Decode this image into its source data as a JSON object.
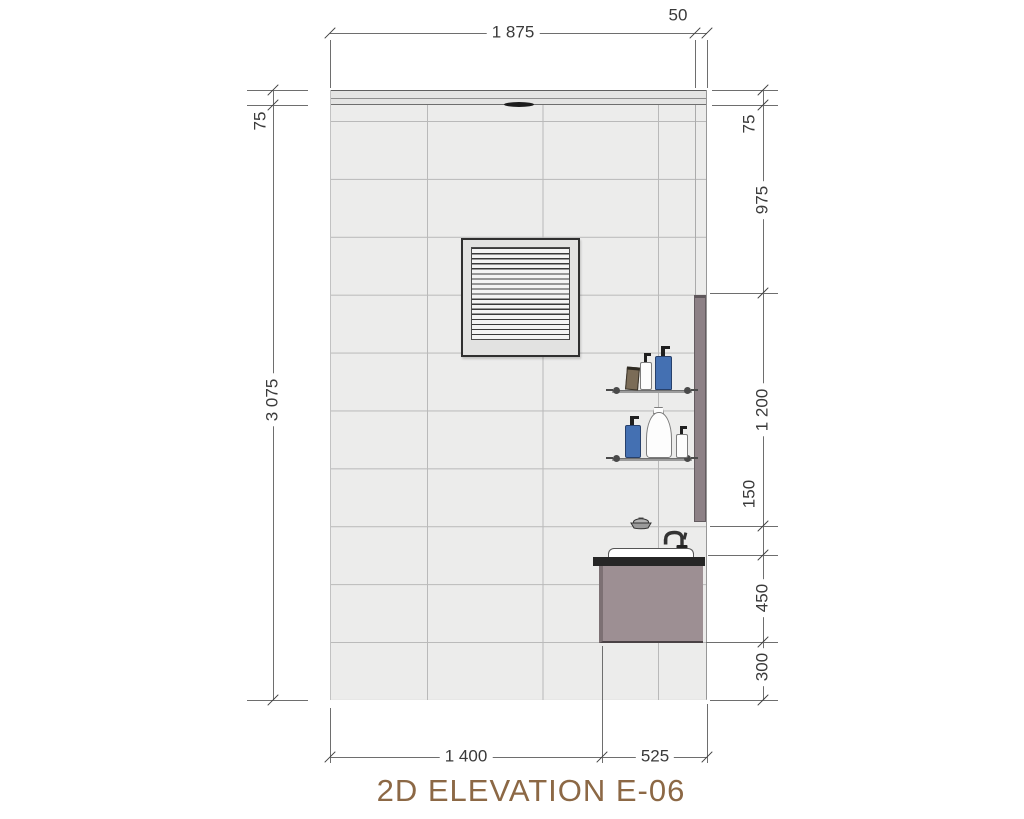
{
  "title": "2D ELEVATION E-06",
  "dimensions": {
    "top": {
      "wall_width": "1 875",
      "edge": "50"
    },
    "left": {
      "band": "75",
      "wall_height": "3 075"
    },
    "right": {
      "band": "75",
      "upper_zone": "975",
      "shelf_zone": "1 200",
      "gap": "150",
      "vanity_height": "450",
      "base": "300"
    },
    "bottom": {
      "wall_segment": "1 400",
      "vanity_segment": "525"
    }
  },
  "vent": {
    "slat_count": 18
  },
  "fixtures": {
    "vent_grille": "louvered ventilation grille",
    "mirror_panel": "side mirror panel",
    "upper_shelf_items": [
      "tan tube",
      "white pump bottle",
      "blue pump bottle"
    ],
    "lower_shelf_items": [
      "blue pump bottle",
      "curvy white bottle",
      "small white pump bottle"
    ],
    "vanity": [
      "soap dish",
      "faucet",
      "washbasin",
      "countertop",
      "vanity cabinet"
    ]
  },
  "colors": {
    "title-brown": "#8C6845",
    "dim-ink": "#3A3A3A",
    "tile": "#ECECEB",
    "grout": "#B9B9B9",
    "band": "#E4E4E3",
    "vent-frame": "#E2E2E1",
    "vent-border": "#2F2F2F",
    "panel": "#8D8186",
    "cabinet": "#9D8F93",
    "cabinet-edge": "#7C7073",
    "counter": "#262626",
    "basin": "#FFFFFF",
    "blue": "#4470B2",
    "tan": "#7B6C57",
    "ink": "#333333"
  }
}
